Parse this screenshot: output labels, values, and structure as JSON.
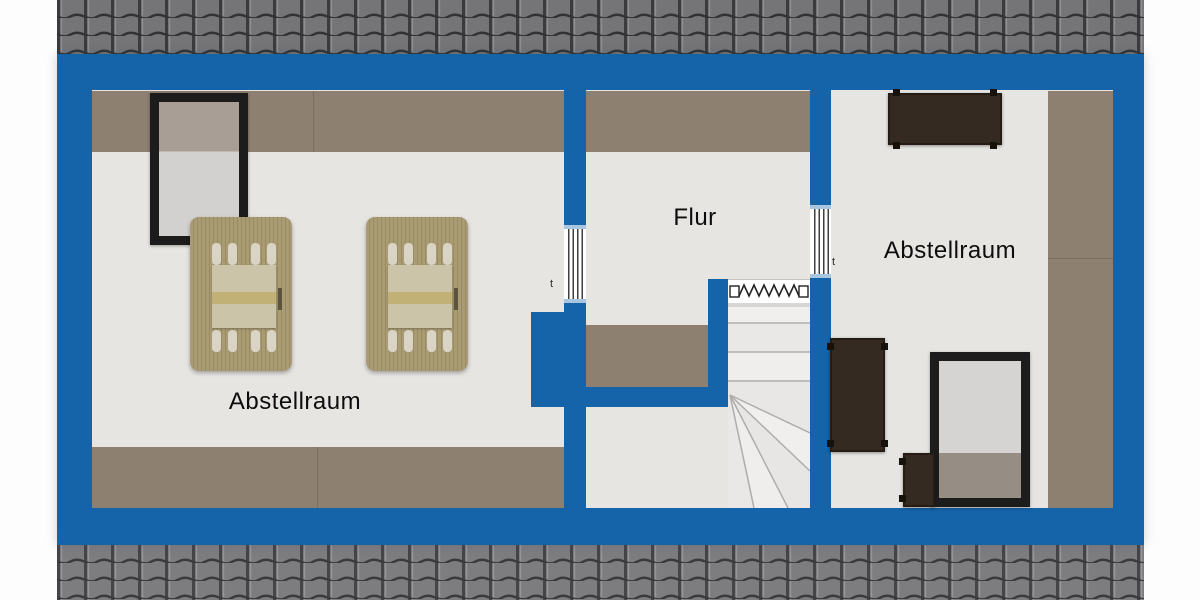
{
  "plan": {
    "type": "floor-plan",
    "level": "attic",
    "rooms": [
      {
        "id": "abstellraum-left",
        "label": "Abstellraum"
      },
      {
        "id": "flur",
        "label": "Flur"
      },
      {
        "id": "abstellraum-right",
        "label": "Abstellraum"
      }
    ],
    "markers": {
      "left_door_tick": "t",
      "right_door_tick": "t"
    },
    "colors": {
      "wall_blue": "#1563a8",
      "floor_gray": "#e6e5e2",
      "sloped_ceiling_taupe": "#8d8071",
      "roof_tile_gray": "#757578",
      "skylight_frame_black": "#1c1c1c",
      "wood_furniture": "#a99c75",
      "dark_furniture": "#342a22"
    },
    "symbols": [
      "roof-tiles",
      "skylight-window",
      "interior-window",
      "folding-door",
      "winder-stairs",
      "lounger",
      "table",
      "bench"
    ]
  }
}
